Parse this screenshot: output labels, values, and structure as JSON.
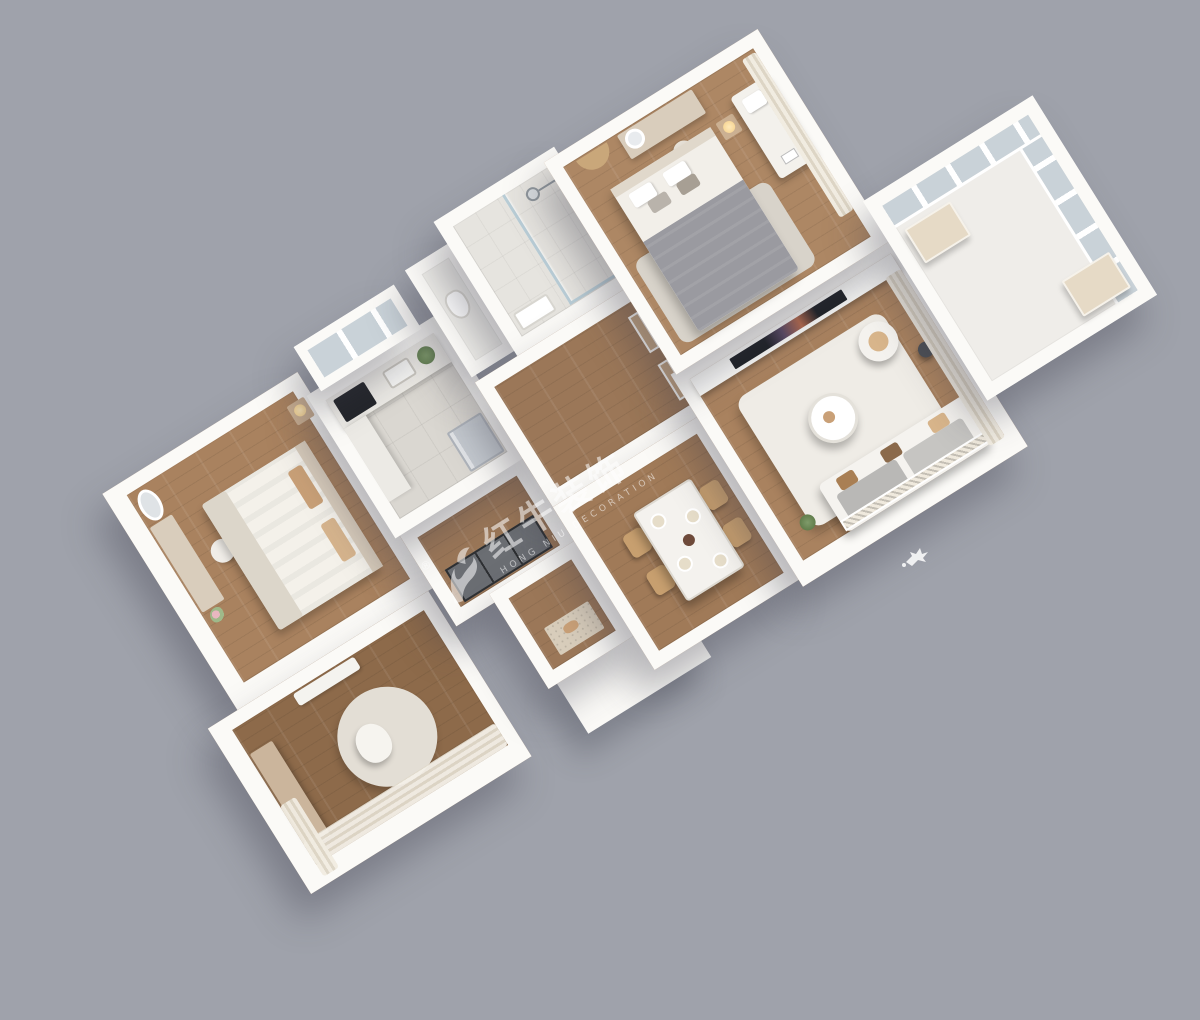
{
  "scene": {
    "kind": "isometric 3D apartment floor-plan rendering",
    "background_color": "#9fa2ab"
  },
  "watermark": {
    "logo_icon": "bull-logo",
    "registered_mark": "®",
    "brand_cn": "红牛装饰",
    "brand_en": "HONG NIU DECORATION",
    "color": "#ffffff",
    "opacity": 0.55
  },
  "palette": {
    "wall": "#fbfaf7",
    "wood_floor": "#a9825f",
    "wood_floor_dark": "#8d6a4a",
    "wood_floor_master": "#ad8764",
    "tile_floor": "#dad7d1",
    "bath_floor": "#e6e4df",
    "rug_light": "#efece6",
    "rug_gray": "#d8d3ca",
    "glass": "#c9d2d8",
    "curtain_cream": "#ece5d8",
    "tv_screen": "#1e2126",
    "cushion_tan": "#c9a077",
    "blanket_gray": "#9a9aa0",
    "wardrobe_dark": "#6b6e73",
    "cabinet_tan": "#e6dac6",
    "fridge_steel": "#c4c9cf",
    "cooktop_black": "#23252a"
  }
}
